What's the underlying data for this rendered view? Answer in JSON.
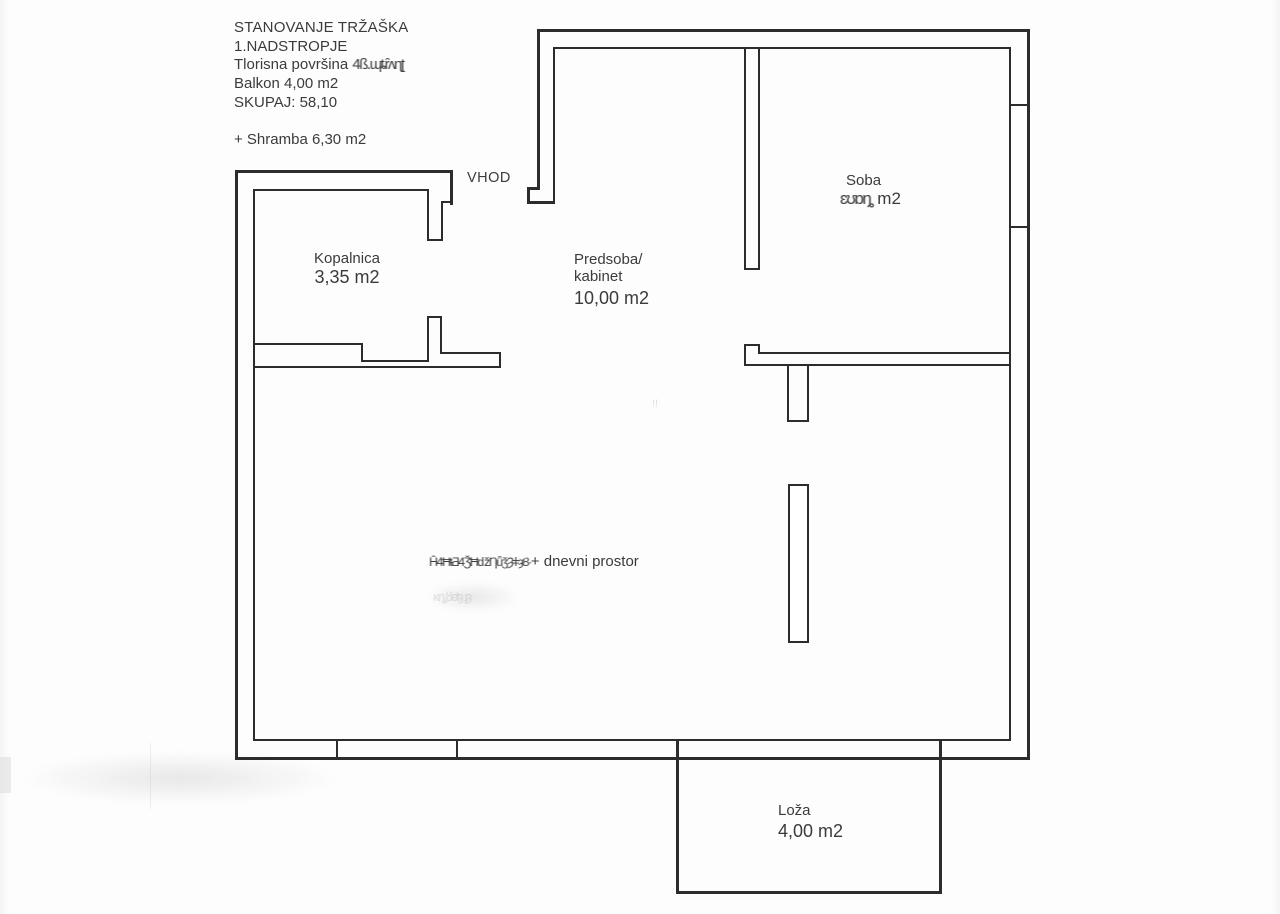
{
  "header": {
    "project_title": "STANOVANJE TRŽAŠKA",
    "floor": "1.NADSTROPJE",
    "floor_area_label": "Tlorisna površina ",
    "floor_area_obscured": "4ß.ɰȶȓʌɳʈ",
    "balcony_line": "Balkon 4,00 m2",
    "total_line": "SKUPAJ: 58,10",
    "storage_line": "+ Shramba 6,30 m2"
  },
  "plan": {
    "entrance_label": "VHOD",
    "faint_mark": "ǃǃ",
    "rooms": {
      "kopalnica": {
        "name": "Kopalnica",
        "area": "3,35 m2"
      },
      "predsoba": {
        "name_line1": "Predsoba/",
        "name_line2": "kabinet",
        "area": "10,00 m2"
      },
      "soba": {
        "name": "Soba",
        "area_obscured": "ɛʊɒȵ",
        "area_unit": " m2"
      },
      "dnevni": {
        "obscured_prefix": "Ĥ4ĦŧƋ4ǮĦǆȠǖǯȜǂȝȢ·",
        "label": "+ dnevni prostor",
        "faint_remnant": "ĸȵȣɛŧȝ ɟȝ"
      },
      "loza": {
        "name": "Loža",
        "area": "4,00 m2"
      }
    }
  },
  "colors": {
    "wall": "#2c2c2c",
    "text": "#3b3b3b",
    "background": "#ffffff"
  }
}
